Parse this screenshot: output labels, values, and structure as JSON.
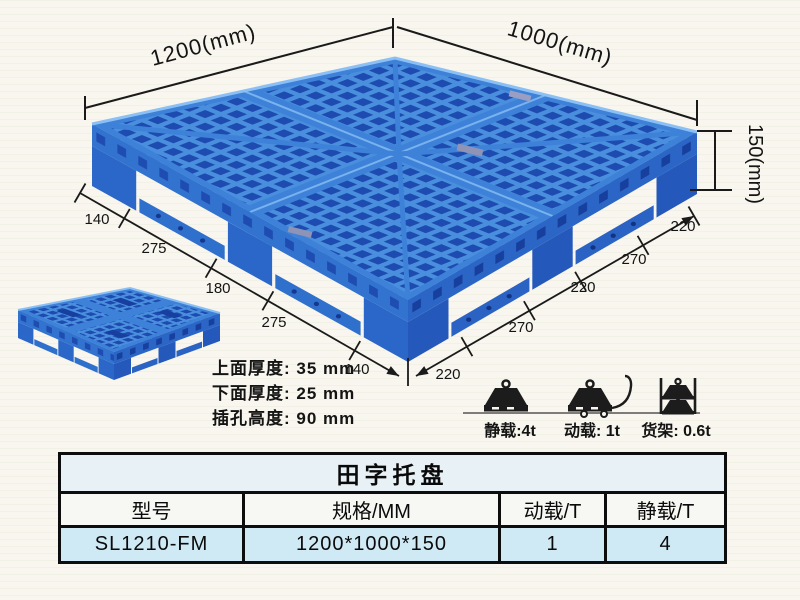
{
  "canvas": {
    "background": "#f8f6ee"
  },
  "pallet_colors": {
    "rib": "#4a8fdd",
    "hole": "#1d4bb0",
    "runner": "#3d82d8",
    "side_left": "#3273cf",
    "side_right": "#2b66c6",
    "leg_left": "#2b67c8",
    "leg_right": "#2458ba",
    "rim_highlight": "#8cc0f4"
  },
  "dimensions": {
    "top_left": "1200(mm)",
    "top_right": "1000(mm)",
    "height": "150(mm)",
    "left_chain": [
      "140",
      "275",
      "180",
      "275",
      "140"
    ],
    "right_chain": [
      "220",
      "270",
      "220",
      "270",
      "220"
    ]
  },
  "notes": {
    "top_thickness": "上面厚度: 35 mm",
    "bottom_thickness": "下面厚度: 25 mm",
    "fork_height": "插孔高度: 90 mm"
  },
  "loads": {
    "static": "静载:4t",
    "dynamic": "动载: 1t",
    "rack": "货架: 0.6t"
  },
  "table": {
    "title": "田字托盘",
    "headers": [
      "型号",
      "规格/MM",
      "动载/T",
      "静载/T"
    ],
    "rows": [
      [
        "SL1210-FM",
        "1200*1000*150",
        "1",
        "4"
      ]
    ]
  }
}
